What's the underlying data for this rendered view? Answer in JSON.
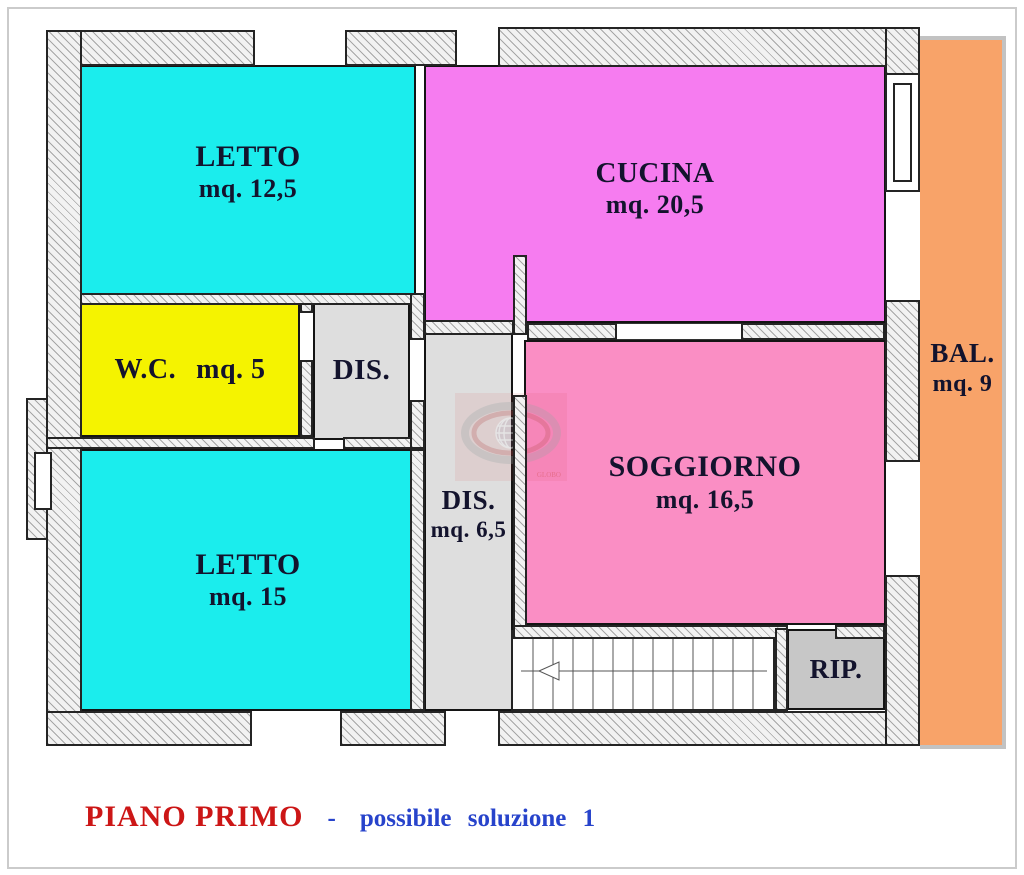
{
  "plan": {
    "rooms": [
      {
        "key": "letto-1",
        "label": "LETTO",
        "area": "mq. 12,5",
        "color": "#1BEDED"
      },
      {
        "key": "cucina",
        "label": "CUCINA",
        "area": "mq. 20,5",
        "color": "#F67CF0"
      },
      {
        "key": "wc",
        "label": "W.C.",
        "area": "mq. 5",
        "color": "#F5F300"
      },
      {
        "key": "dis-upper",
        "label": "DIS.",
        "area": "",
        "color": "#DEDEDE"
      },
      {
        "key": "dis-corridor",
        "label": "DIS.",
        "area": "mq. 6,5",
        "color": "#DEDEDE"
      },
      {
        "key": "soggiorno",
        "label": "SOGGIORNO",
        "area": "mq. 16,5",
        "color": "#FA8EC4"
      },
      {
        "key": "letto-2",
        "label": "LETTO",
        "area": "mq. 15",
        "color": "#1BEDED"
      },
      {
        "key": "balcony",
        "label": "BAL.",
        "area": "mq. 9",
        "color": "#F8A369"
      },
      {
        "key": "rip",
        "label": "RIP.",
        "area": "",
        "color": "#C7C7C7"
      }
    ]
  },
  "watermark": {
    "text": "GLOBO"
  },
  "caption": {
    "title": "PIANO PRIMO",
    "separator": "-",
    "subtitle": "possibile soluzione 1",
    "title_color": "#CC1616",
    "subtitle_color": "#2743CB"
  }
}
